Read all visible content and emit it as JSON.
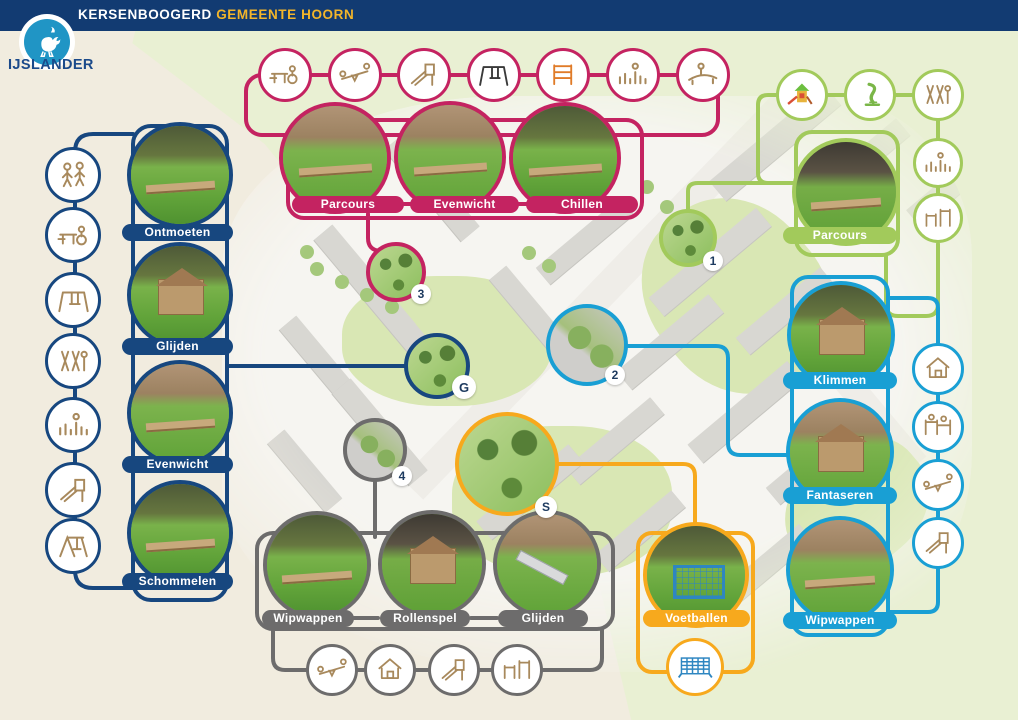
{
  "header": {
    "project_name": "KERSENBOOGERD",
    "municipality": "GEMEENTE HOORN",
    "brand": "IJSLANDER"
  },
  "palette": {
    "header_bar": "#123B72",
    "navy": "#17477F",
    "pink": "#C42361",
    "green": "#A2CA5B",
    "blue": "#199FD4",
    "gray": "#6D6C6C",
    "yellow": "#F7A91D",
    "municipality_text": "#F2B52A"
  },
  "groups": {
    "meeting_navy": {
      "photo_labels": [
        "Ontmoeten",
        "Glijden",
        "Evenwicht",
        "Schommelen"
      ],
      "equipment_icons": [
        "two-children-icon",
        "picnic-bench-wheelchair-icon",
        "swing-icon",
        "climbing-posts-icon",
        "stepping-poles-icon",
        "play-tower-icon",
        "frame-swing-icon"
      ],
      "map_badge": "G"
    },
    "parcours_pink": {
      "photo_labels": [
        "Parcours",
        "Evenwicht",
        "Chillen"
      ],
      "equipment_icons": [
        "picnic-bench-wheelchair-icon",
        "seesaw-icon",
        "slide-icon",
        "swing-icon",
        "climbing-frame-icon",
        "stepping-posts-icon",
        "balance-beam-icon"
      ],
      "map_badge": "3"
    },
    "parcours_green": {
      "photo_labels": [
        "Parcours"
      ],
      "equipment_icons": [
        "color-play-tower-icon",
        "spring-rider-icon",
        "climbing-posts-icon",
        "stepping-posts-icon",
        "parallel-bars-icon"
      ],
      "map_badge": "1"
    },
    "climbing_blue": {
      "photo_labels": [
        "Klimmen",
        "Fantaseren",
        "Wipwappen"
      ],
      "equipment_icons": [
        "playhouse-icon",
        "play-bars-icon",
        "seesaw-icon",
        "tower-slide-icon"
      ],
      "map_badge": "2"
    },
    "play_gray": {
      "photo_labels": [
        "Wipwappen",
        "Rollenspel",
        "Glijden"
      ],
      "equipment_icons": [
        "seesaw-icon",
        "playhouse-icon",
        "tower-slide-icon",
        "parallel-bars-icon"
      ],
      "map_badge": "4"
    },
    "football_yellow": {
      "photo_labels": [
        "Voetballen"
      ],
      "equipment_icons": [
        "soccer-goal-icon"
      ],
      "map_badge": "S"
    }
  },
  "map": {
    "badges": [
      "1",
      "2",
      "3",
      "4",
      "G",
      "S"
    ]
  }
}
